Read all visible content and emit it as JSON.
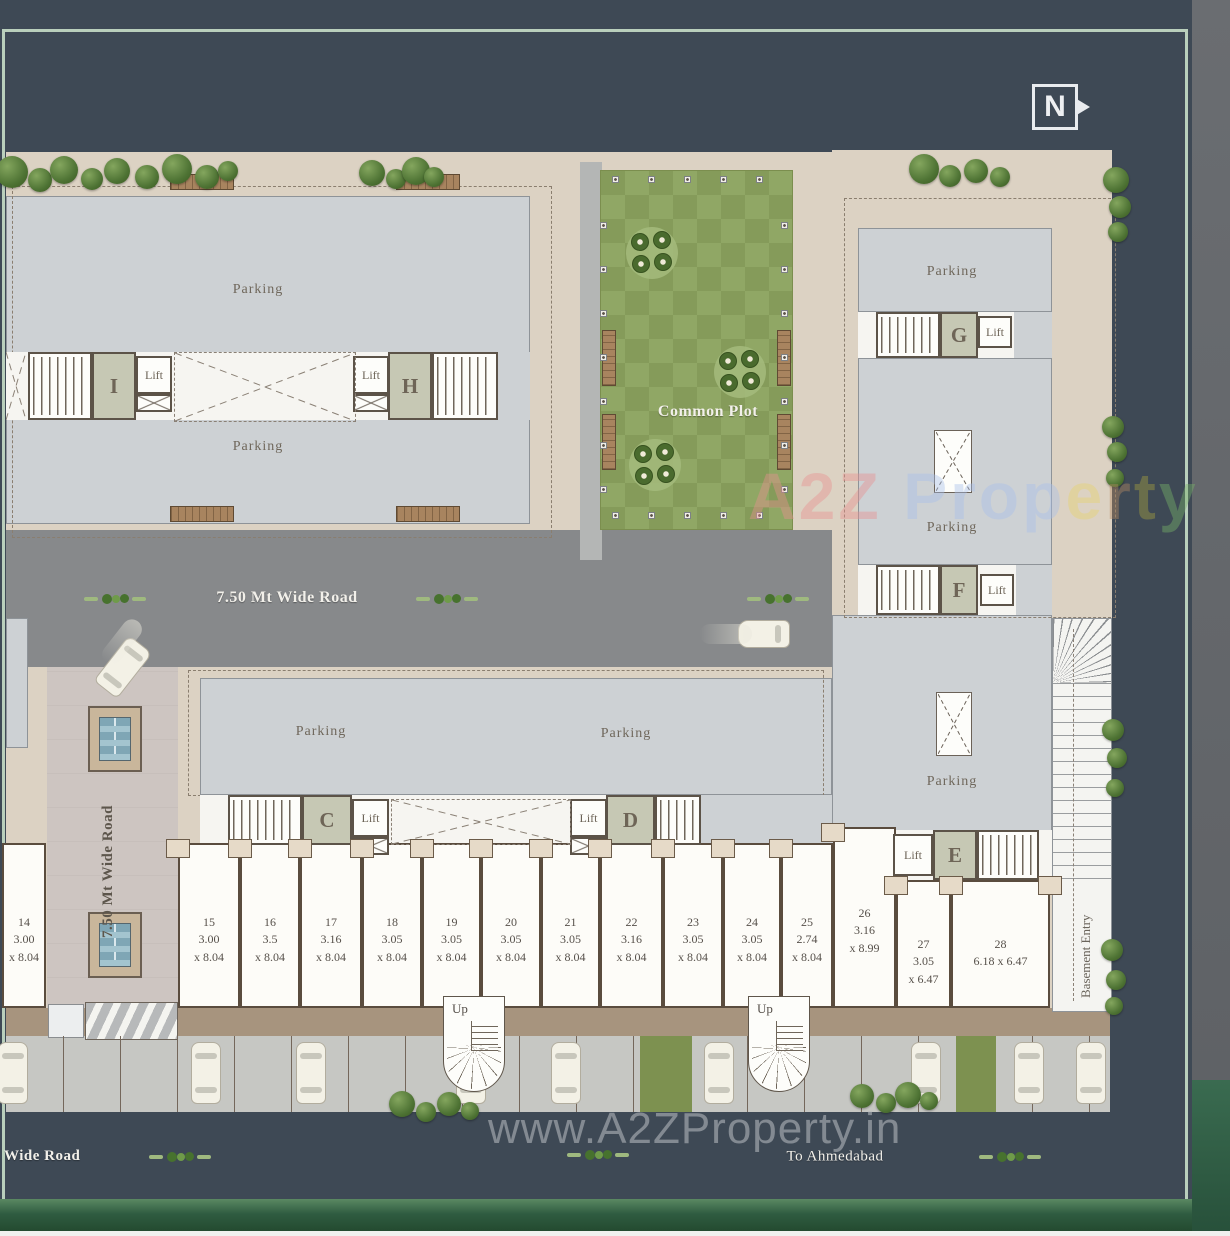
{
  "north_label": "N",
  "labels": {
    "parking": "Parking",
    "lift": "Lift",
    "common_plot": "Common Plot",
    "up": "Up",
    "basement_entry": "Basement Entry"
  },
  "blocks": [
    "I",
    "H",
    "G",
    "F",
    "C",
    "D",
    "E"
  ],
  "roads": {
    "horizontal": "7.50 Mt Wide Road",
    "vertical": "7.50 Mt Wide Road",
    "bottom_left": "Wide Road",
    "bottom_destination": "To Ahmedabad"
  },
  "units": [
    {
      "no": "14",
      "l1": "3.00",
      "l2": "x 8.04"
    },
    {
      "no": "15",
      "l1": "3.00",
      "l2": "x 8.04"
    },
    {
      "no": "16",
      "l1": "3.5",
      "l2": "x 8.04"
    },
    {
      "no": "17",
      "l1": "3.16",
      "l2": "x 8.04"
    },
    {
      "no": "18",
      "l1": "3.05",
      "l2": "x 8.04"
    },
    {
      "no": "19",
      "l1": "3.05",
      "l2": "x 8.04"
    },
    {
      "no": "20",
      "l1": "3.05",
      "l2": "x 8.04"
    },
    {
      "no": "21",
      "l1": "3.05",
      "l2": "x 8.04"
    },
    {
      "no": "22",
      "l1": "3.16",
      "l2": "x 8.04"
    },
    {
      "no": "23",
      "l1": "3.05",
      "l2": "x 8.04"
    },
    {
      "no": "24",
      "l1": "3.05",
      "l2": "x 8.04"
    },
    {
      "no": "25",
      "l1": "2.74",
      "l2": "x 8.04"
    },
    {
      "no": "26",
      "l1": "3.16",
      "l2": "x 8.99"
    },
    {
      "no": "27",
      "l1": "3.05",
      "l2": "x 6.47"
    },
    {
      "no": "28",
      "l1": "6.18 x 6.47",
      "l2": ""
    }
  ],
  "watermarks": {
    "center_url": "www.A2ZProperty.in",
    "brand_letters": [
      {
        "ch": "A",
        "color": "#e89090"
      },
      {
        "ch": "2",
        "color": "#e89090"
      },
      {
        "ch": "Z",
        "color": "#e89090"
      },
      {
        "ch": " ",
        "color": "#ffffff"
      },
      {
        "ch": "P",
        "color": "#a9c0ea"
      },
      {
        "ch": "r",
        "color": "#a9c0ea"
      },
      {
        "ch": "o",
        "color": "#a9c0ea"
      },
      {
        "ch": "p",
        "color": "#a9c0ea"
      },
      {
        "ch": "e",
        "color": "#e6d36e"
      },
      {
        "ch": "r",
        "color": "#b58a62"
      },
      {
        "ch": "t",
        "color": "#a8a23f"
      },
      {
        "ch": "y",
        "color": "#79b468"
      }
    ]
  },
  "colors": {
    "frame": "#b9cfbc",
    "road_dark": "#3e4955",
    "road_gray": "#87898b",
    "plot_beige": "#dcd2c3",
    "building_gray": "#cdd1d4",
    "common_plot_green": "#8ea45f",
    "stall_green": "#7d9150"
  }
}
